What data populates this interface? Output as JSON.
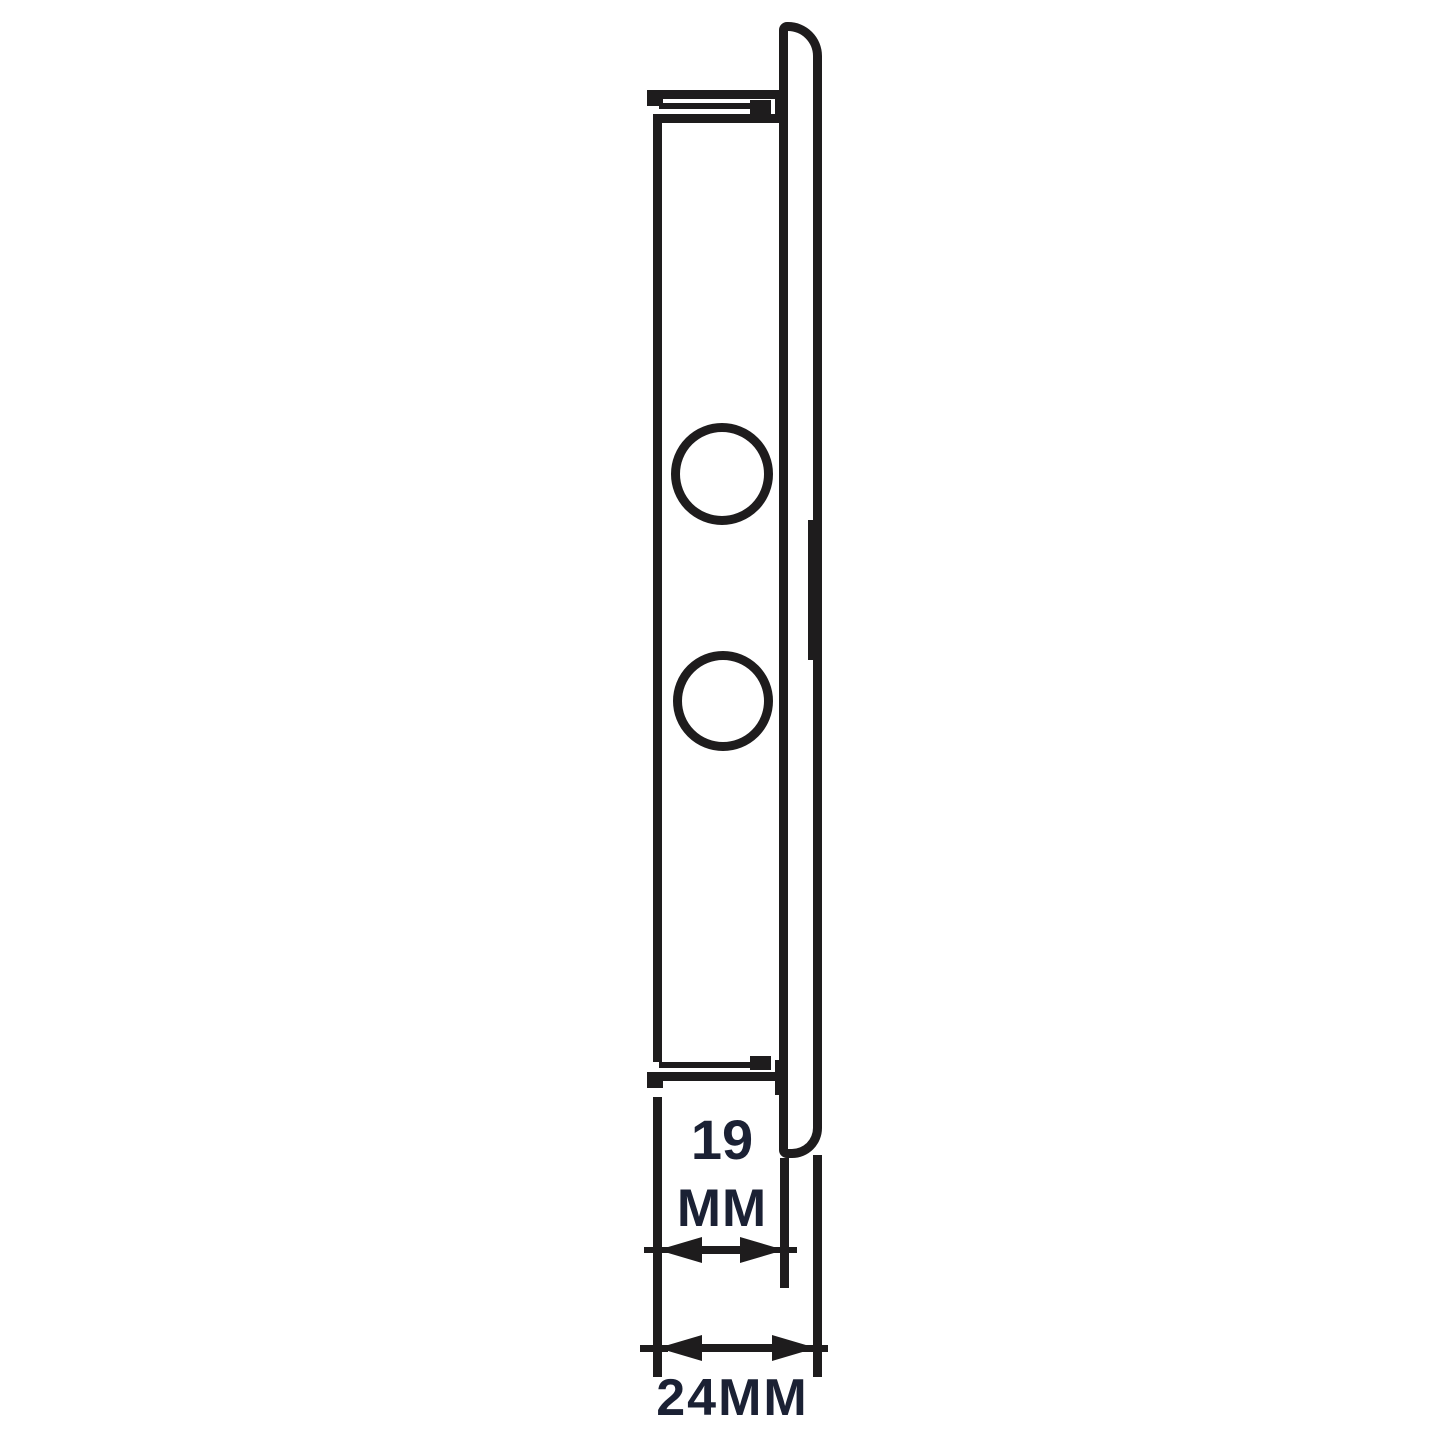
{
  "diagram": {
    "line_color": "#1e1c1d",
    "text_color": "#1b2134",
    "background_color": "#ffffff",
    "subject": "wall-plate-side-profile",
    "hole_count": 2,
    "dimensions": [
      {
        "id": "plate-depth",
        "value": "19",
        "unit": "MM",
        "line1": "19",
        "line2": "MM"
      },
      {
        "id": "overall-depth",
        "value": "24",
        "unit": "MM",
        "label": "24MM"
      }
    ]
  }
}
